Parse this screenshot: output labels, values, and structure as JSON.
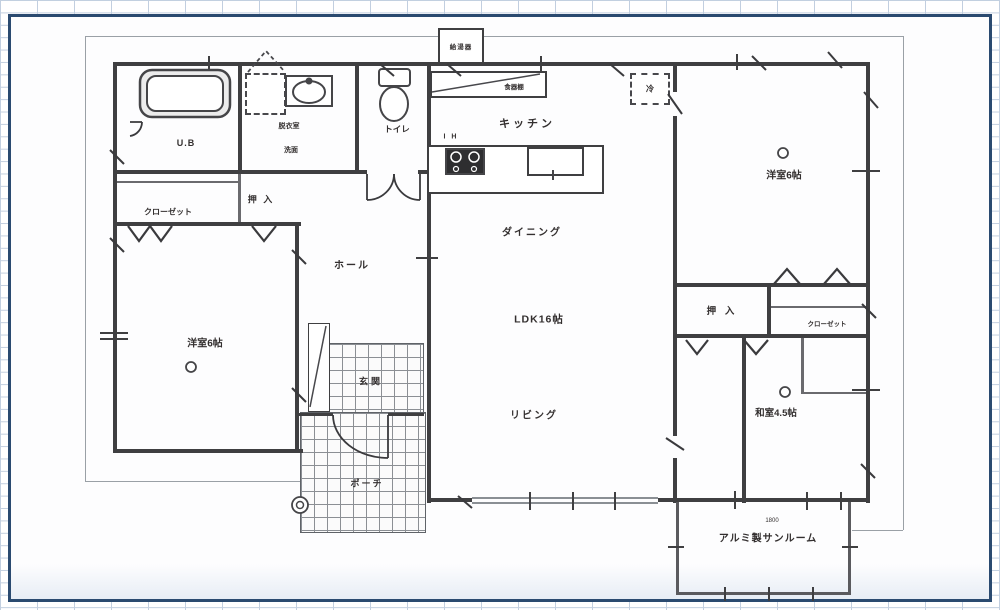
{
  "plan": {
    "labels": {
      "ub": "U.B",
      "dressing": "脱衣室",
      "washstand": "洗面",
      "toilet": "トイレ",
      "kitchen": "キッチン",
      "dining": "ダイニング",
      "ldk": "LDK16帖",
      "living": "リビング",
      "hall": "ホール",
      "genkan": "玄関",
      "porch": "ポーチ",
      "closet_left": "クローゼット",
      "oshiire_left": "押 入",
      "western_room_left": "洋室6帖",
      "western_room_right": "洋室6帖",
      "oshiire_right": "押 入",
      "closet_right": "クローゼット",
      "japanese_room": "和室4.5帖",
      "sunroom": "アルミ製サンルーム",
      "water_heater": "給湯器",
      "cupboard": "食器棚",
      "fridge": "冷",
      "ih": "I H",
      "sunroom_width": "1800"
    },
    "colors": {
      "border": "#2a4a70",
      "wall": "#3f3f41",
      "grid_line": "#c2cfe0"
    }
  }
}
